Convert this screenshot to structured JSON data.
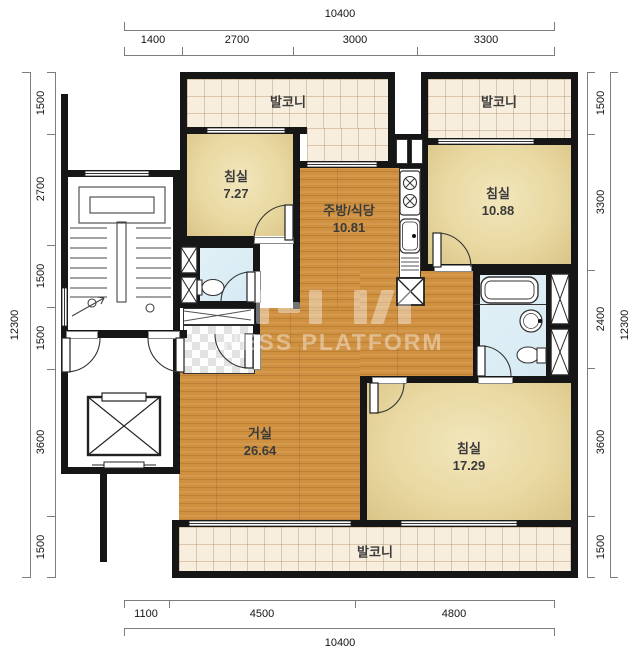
{
  "watermark": {
    "text": "NESS PLATFORM"
  },
  "rooms": {
    "balcony_top_left": {
      "name": "발코니"
    },
    "balcony_top_right": {
      "name": "발코니"
    },
    "bedroom1": {
      "name": "침실",
      "area": "7.27"
    },
    "kitchen": {
      "name": "주방/식당",
      "area": "10.81"
    },
    "bedroom2": {
      "name": "침실",
      "area": "10.88"
    },
    "living": {
      "name": "거실",
      "area": "26.64"
    },
    "bedroom3": {
      "name": "침실",
      "area": "17.29"
    },
    "balcony_bottom": {
      "name": "발코니"
    }
  },
  "dimensions": {
    "top": {
      "total": "10400",
      "segments": [
        "1400",
        "2700",
        "3000",
        "3300"
      ]
    },
    "bottom": {
      "total": "10400",
      "segments": [
        "1100",
        "4500",
        "4800"
      ]
    },
    "left": {
      "total": "12300",
      "segments": [
        "1500",
        "2700",
        "1500",
        "1500",
        "3600",
        "1500"
      ]
    },
    "right": {
      "total": "12300",
      "segments": [
        "1500",
        "3300",
        "2400",
        "3600",
        "1500"
      ]
    }
  },
  "colors": {
    "wall": "#161616",
    "wood_floor": "#cf9040",
    "bedroom_floor": "#e9d9a2",
    "balcony_tile": "#f8eedd",
    "bathroom": "#d6eaf3"
  }
}
